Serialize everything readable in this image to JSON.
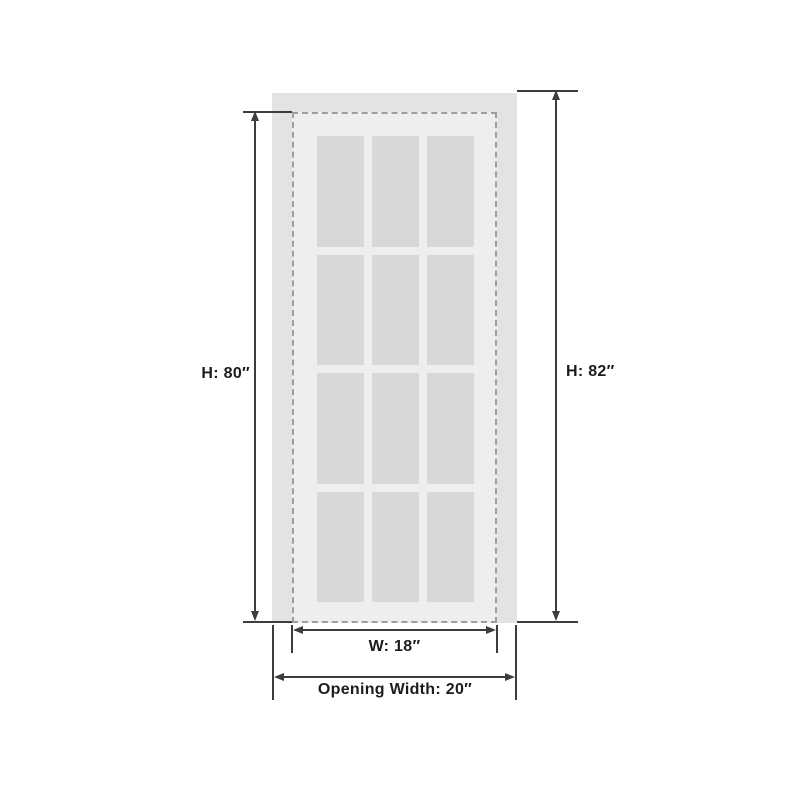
{
  "diagram": {
    "type": "dimension-diagram",
    "subject": "Interior door with 12 glass panes shown inside wall opening",
    "door": {
      "pane_rows": 4,
      "pane_cols": 3,
      "pane_count": 12
    },
    "dimensions": [
      {
        "id": "door-height",
        "label": "H: 80″",
        "value": 80,
        "unit": "in"
      },
      {
        "id": "opening-height",
        "label": "H: 82″",
        "value": 82,
        "unit": "in"
      },
      {
        "id": "door-width",
        "label": "W: 18″",
        "value": 18,
        "unit": "in"
      },
      {
        "id": "opening-width",
        "label": "Opening Width: 20″",
        "value": 20,
        "unit": "in"
      }
    ]
  },
  "colors": {
    "page-bg": "#ffffff",
    "opening-bg": "#e3e3e3",
    "door-bg": "#eeeeee",
    "pane-bg": "#d8d8d8",
    "dash-color": "#9e9e9e",
    "line-color": "#3d3d3d",
    "text-color": "#1c1c1e"
  }
}
